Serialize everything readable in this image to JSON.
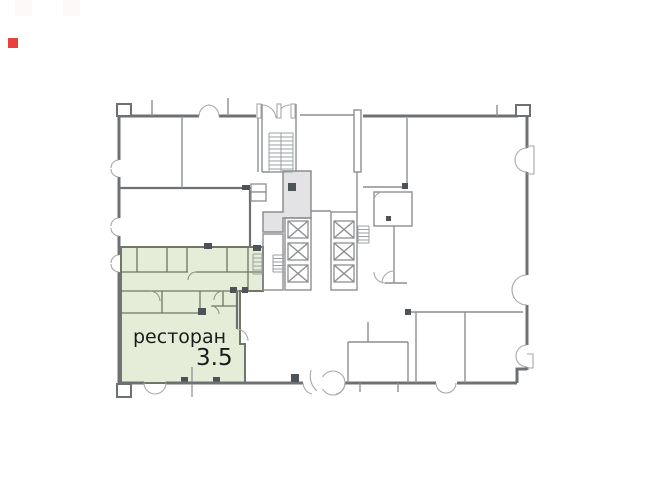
{
  "plan": {
    "label": "ресторан",
    "value": "3.5",
    "colors": {
      "background": "#ffffff",
      "wall": "#6e7173",
      "wall_light": "#8c8e90",
      "door_arc": "#a6a8aa",
      "highlight_fill": "#e5edd8",
      "highlight_stroke": "#70766a",
      "highlight_wall": "#6f7566",
      "lobby_fill": "#e3e3e5",
      "lobby_stroke": "#8c8e90",
      "dark_marker": "#4e5357",
      "text": "#1b1b1b",
      "red_marker": "#e8423d"
    }
  }
}
